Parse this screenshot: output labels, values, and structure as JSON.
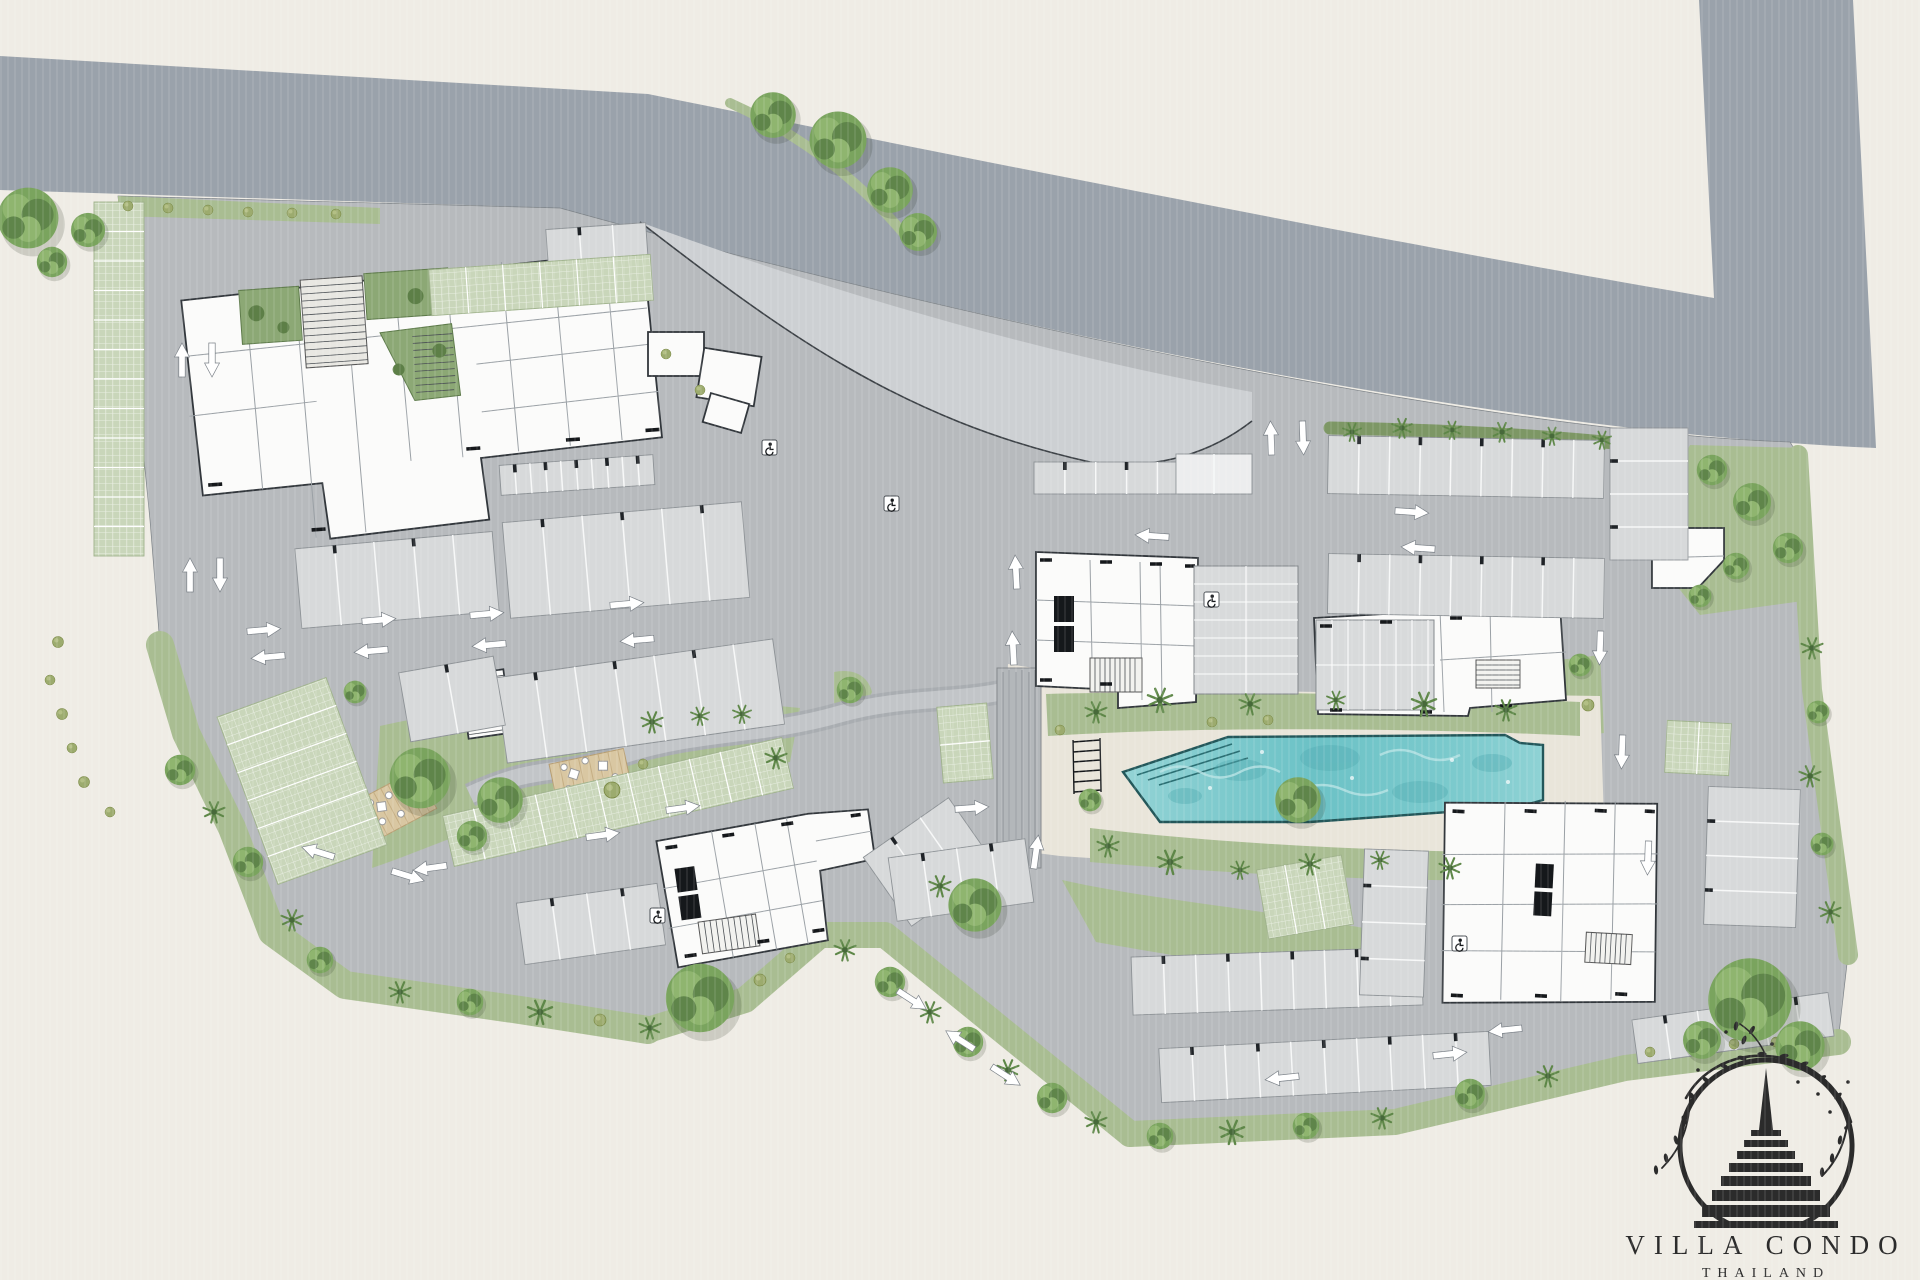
{
  "document": {
    "kind": "architectural master site plan"
  },
  "logo": {
    "title": "VILLA CONDO",
    "subtitle": "THAILAND",
    "emblem": "chedi-stupa-in-branch-ring"
  },
  "icons": {
    "accessible_parking": "wheelchair-icon",
    "traffic": "direction-arrow-icon",
    "vegetation": "tree-icon"
  },
  "palette": {
    "background": "#efece5",
    "road": "#9aa2ab",
    "apron": "#cdd0d3",
    "site": "#b7babd",
    "stall": "#d7d9da",
    "garage": "#ecedee",
    "building": "#fbfbfa",
    "buildingLine": "#32373c",
    "wallInk": "#15181b",
    "detail": "#9aa0a5",
    "lawn": "#a9bd92",
    "hedge": "#7d9765",
    "paver": "#c9d7ba",
    "treeMid": "#7aa45e",
    "treeDark": "#5f854a",
    "treeLight": "#8fb56f",
    "olive": "#9cab6e",
    "palm": "#5e8748",
    "poolWater": "#7ec9cd",
    "poolDeep": "#55aeb3",
    "poolLight": "#b9e4e5",
    "poolEdge": "#23575a",
    "deckSand": "#e9e5da",
    "wood": "#d9c7a2",
    "stone": "#a9adb1",
    "arrow": "#ffffff",
    "ink": "#2b2b2b"
  }
}
